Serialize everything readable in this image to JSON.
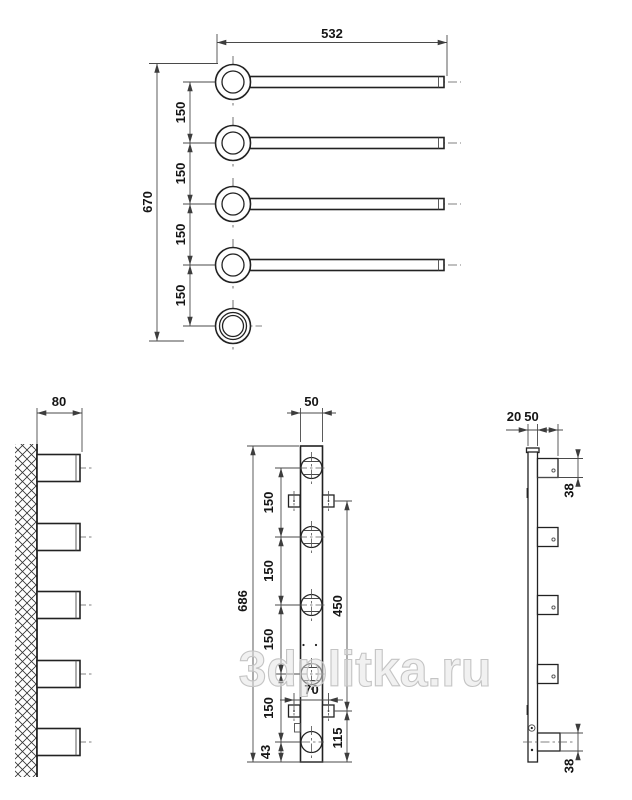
{
  "watermark": {
    "text": "3dplitka.ru",
    "color": "#c9c9c9"
  },
  "colors": {
    "line": "#222222",
    "dimension": "#4a4a4a",
    "background": "#ffffff"
  },
  "top_view": {
    "length_label": "532",
    "height_label": "670",
    "spacing_labels": [
      "150",
      "150",
      "150",
      "150"
    ]
  },
  "wall_side_view": {
    "depth_label": "80"
  },
  "front_view": {
    "width_label": "50",
    "height_label": "686",
    "spacing_labels": [
      "150",
      "150",
      "150",
      "150"
    ],
    "bottom_offset_label": "43",
    "bracket_span_label": "450",
    "bracket_width_label": "70",
    "bottom_span_label": "115"
  },
  "side_view": {
    "thickness_label": "20",
    "depth_label": "50",
    "top_rail_height_label": "38",
    "bottom_rail_height_label": "38"
  }
}
